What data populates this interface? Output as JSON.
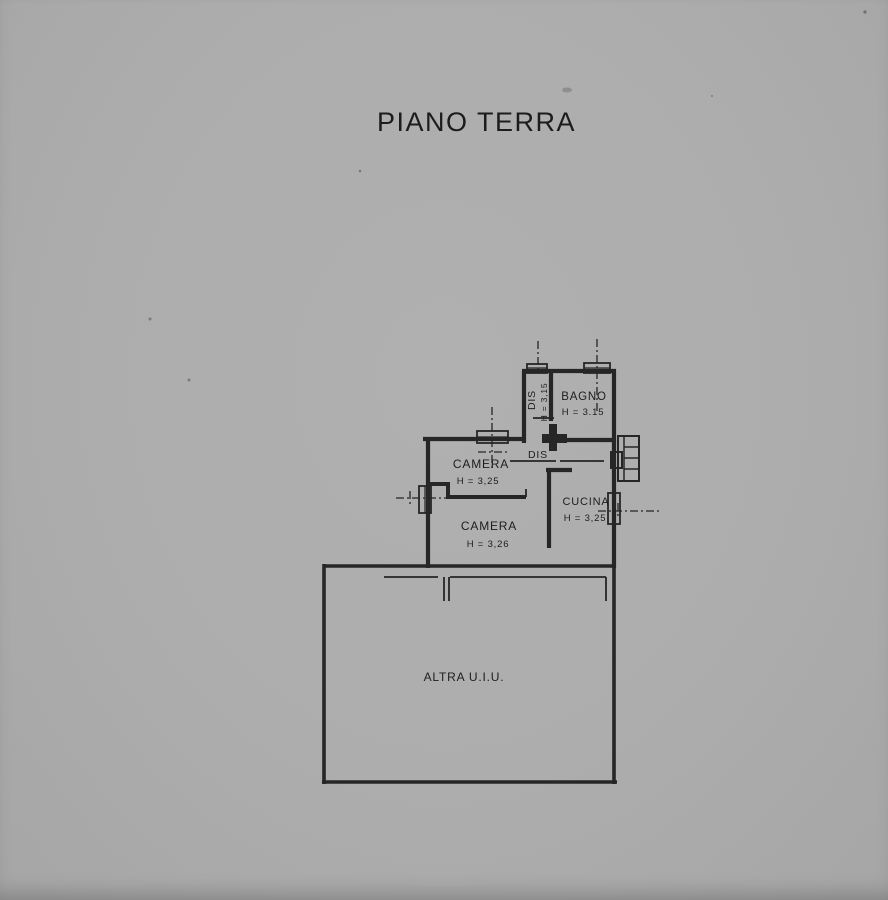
{
  "page": {
    "title": "PIANO TERRA",
    "background_color": "#adadad",
    "ink_color": "#262626",
    "document_type": "scanned cadastral floor plan"
  },
  "rooms": {
    "dis_corridor": {
      "label": "DIS",
      "height": "H = 3,15"
    },
    "bagno": {
      "label": "BAGNO",
      "height": "H = 3.15"
    },
    "dis_landing": {
      "label": "DIS"
    },
    "camera_upper": {
      "label": "CAMERA",
      "height": "H = 3,25"
    },
    "camera_lower": {
      "label": "CAMERA",
      "height": "H = 3,26"
    },
    "cucina": {
      "label": "CUCINA",
      "height": "H = 3,25"
    },
    "altra_uiu": {
      "label": "ALTRA U.I.U."
    }
  }
}
